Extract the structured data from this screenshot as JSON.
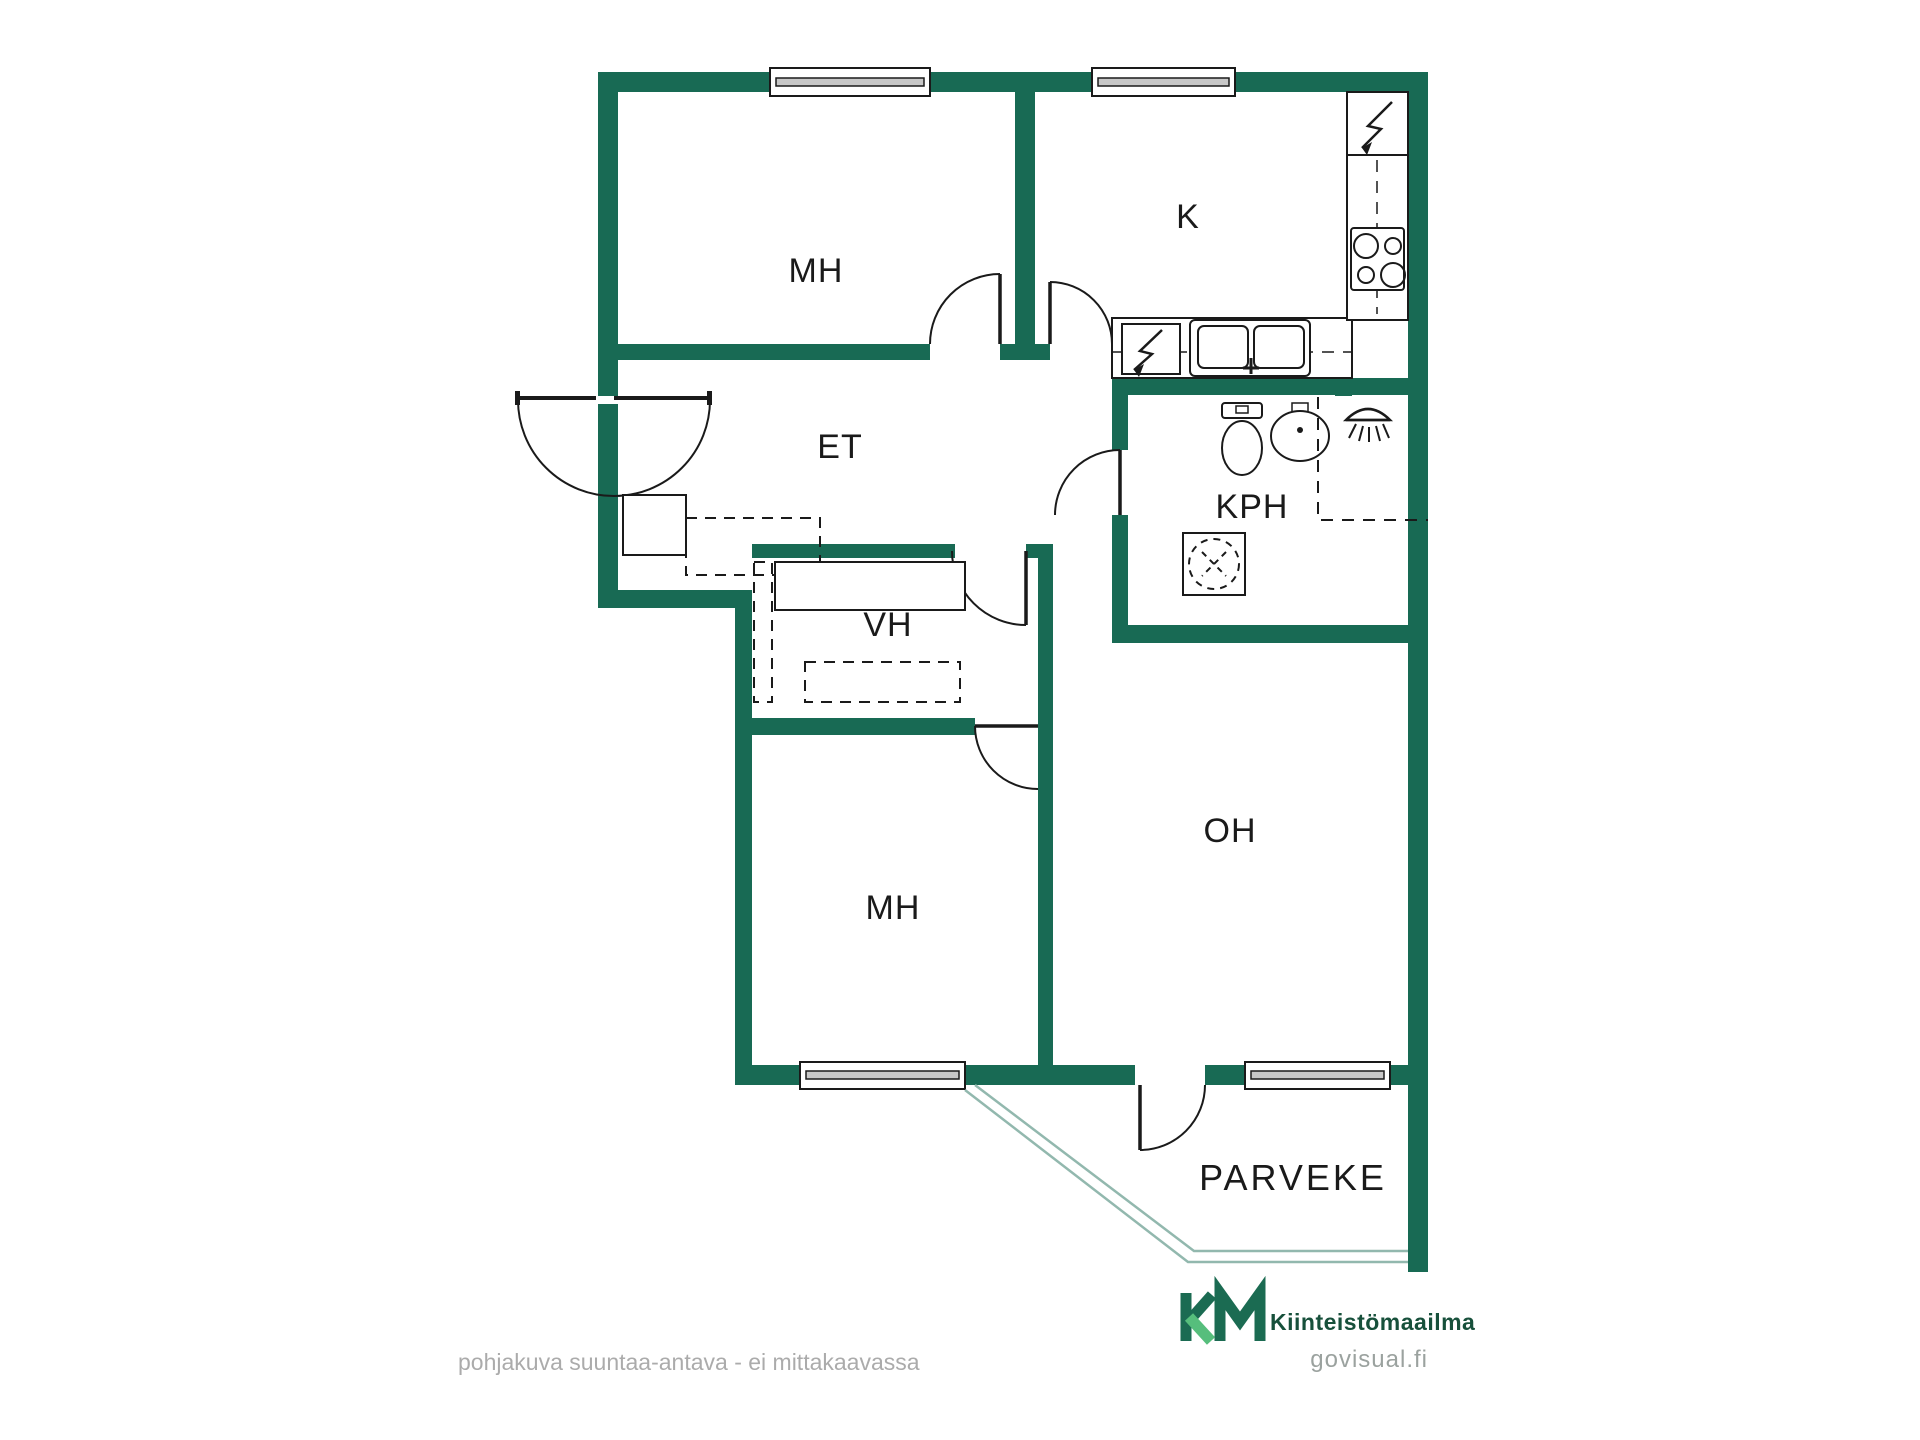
{
  "rooms": {
    "bedroom_1": {
      "label": "MH"
    },
    "kitchen": {
      "label": "K"
    },
    "entry": {
      "label": "ET"
    },
    "bathroom": {
      "label": "KPH"
    },
    "closet": {
      "label": "VH"
    },
    "bedroom_2": {
      "label": "MH"
    },
    "living_room": {
      "label": "OH"
    },
    "balcony": {
      "label": "PARVEKE"
    }
  },
  "footer": {
    "disclaimer": "pohjakuva suuntaa-antava - ei mittakaavassa"
  },
  "branding": {
    "company": "Kiinteistömaailma",
    "watermark": "govisual.fi"
  },
  "colors": {
    "wall": "#186A54",
    "line": "#1A1A1A",
    "window_bar": "#C8C8C8",
    "railing": "#92B8AE",
    "label": "#1A1A1A",
    "muted": "#ABABAB",
    "logo_dark": "#1B6B52",
    "logo_light": "#56BE7C",
    "logo_text": "#17503B",
    "watermark_color": "#9BA29F"
  }
}
